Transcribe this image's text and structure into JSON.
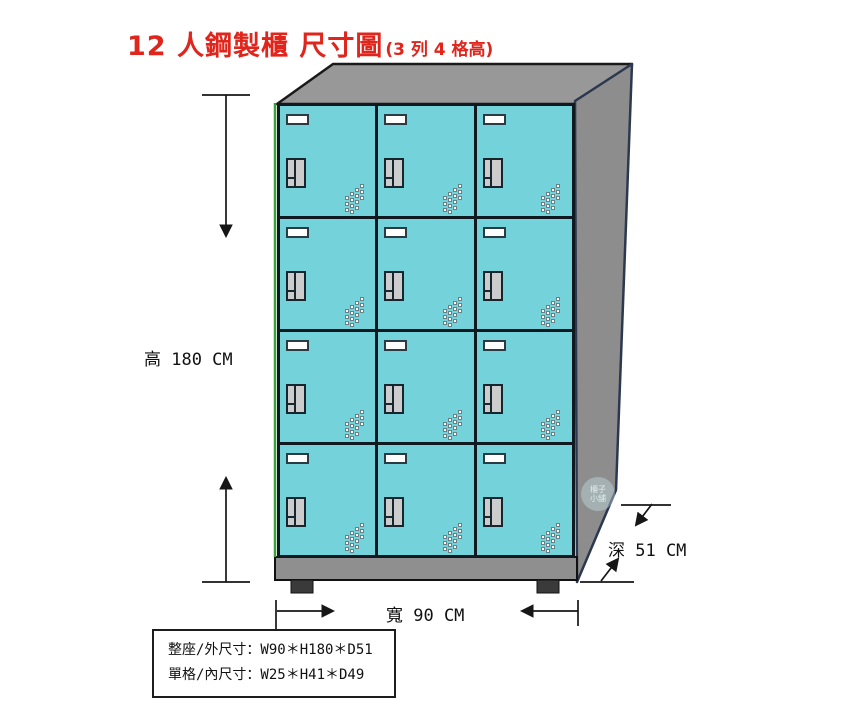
{
  "title": {
    "main": "12 人鋼製櫃 尺寸圖",
    "sub": "(3 列 4 格高)"
  },
  "dimensions": {
    "height_label": "高 180 CM",
    "width_label": "寬 90 CM",
    "depth_label": "深 51 CM"
  },
  "spec_box": {
    "line1": "整座/外尺寸：W90＊H180＊D51",
    "line2": "單格/內尺寸：W25＊H41＊D49"
  },
  "locker": {
    "rows": 4,
    "columns": 3,
    "door_count": 12
  },
  "watermark": {
    "line1": "櫃子",
    "line2": "小舖"
  },
  "colors": {
    "title_red": "#e0251c",
    "door_cyan": "#74d3da",
    "top_gray": "#989898",
    "side_gray": "#8d8d8d",
    "base_gray": "#8f8f8f",
    "outline_dark": "#10191f",
    "side_outline_navy": "#2c3850",
    "left_edge_green": "#3da03d"
  }
}
